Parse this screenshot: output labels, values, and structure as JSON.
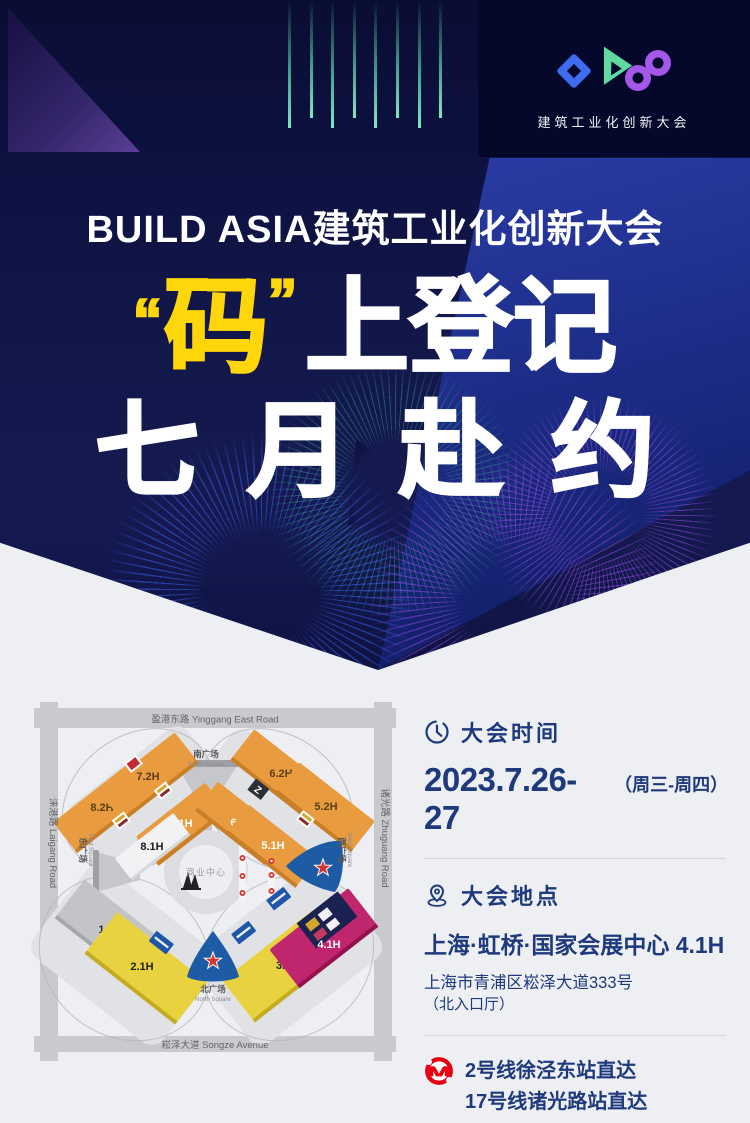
{
  "poster": {
    "brand": {
      "name_label": "建筑工业化创新大会"
    },
    "hero": {
      "title": "BUILD ASIA建筑工业化创新大会",
      "slogan": {
        "quote_open": "“",
        "highlight": "码",
        "quote_close": "”",
        "line1_rest": "上登记",
        "line2": "七月赴约"
      }
    },
    "info": {
      "time": {
        "heading": "大会时间",
        "date": "2023.7.26-27",
        "days": "（周三-周四）"
      },
      "place": {
        "heading": "大会地点",
        "venue": "上海·虹桥·国家会展中心 4.1H",
        "address": "上海市青浦区崧泽大道333号",
        "address_note": "（北入口厅）"
      },
      "metro": {
        "line1": "2号线徐泾东站直达",
        "line2": "17号线诸光路站直达"
      }
    },
    "map": {
      "roads": {
        "top": "盈港东路 Yinggang East Road",
        "bottom": "崧泽大道 Songze Avenue",
        "left": "涞港路 Laigang Road",
        "right": "诸光路 Zhuguang Road"
      },
      "squares": {
        "south_zh": "南广场",
        "south_en": "South Square",
        "north_zh": "北广场",
        "north_en": "North Square",
        "east_zh": "东广场",
        "east_en": "East Square",
        "west_zh": "西广场",
        "west_en": "West Square"
      },
      "center": "商业中心",
      "halls": [
        {
          "label": "8.2H",
          "fill": "#e99c3f",
          "text": "#5a4014"
        },
        {
          "label": "7.2H",
          "fill": "#e99c3f",
          "text": "#5a4014"
        },
        {
          "label": "7.1H",
          "fill": "#e99c3f",
          "text": "#ffffff"
        },
        {
          "label": "8.1H",
          "fill": "#f2f2f4",
          "text": "#1a1a1a"
        },
        {
          "label": "6.2H",
          "fill": "#e99c3f",
          "text": "#5a4014"
        },
        {
          "label": "6.1H",
          "fill": "#e99c3f",
          "text": "#ffffff"
        },
        {
          "label": "5.2H",
          "fill": "#e99c3f",
          "text": "#5a4014"
        },
        {
          "label": "5.1H",
          "fill": "#e99c3f",
          "text": "#ffffff"
        },
        {
          "label": "1.1H",
          "fill": "#c3c4c8",
          "text": "#2e2e2e"
        },
        {
          "label": "2.1H",
          "fill": "#e8d23f",
          "text": "#1f1f1f"
        },
        {
          "label": "3H",
          "fill": "#e8d23f",
          "text": "#1f1f1f"
        },
        {
          "label": "4.1H",
          "fill": "#c0266d",
          "text": "#ffffff"
        }
      ]
    },
    "colors": {
      "accent_yellow": "#ffd60a",
      "navy_text": "#1e3a7c",
      "metro_red": "#e60012",
      "entrance_blue": "#1d5ca4",
      "logo_blue": "#3e6cf0",
      "logo_green": "#5fd9a0",
      "logo_purple": "#a358e8"
    }
  }
}
